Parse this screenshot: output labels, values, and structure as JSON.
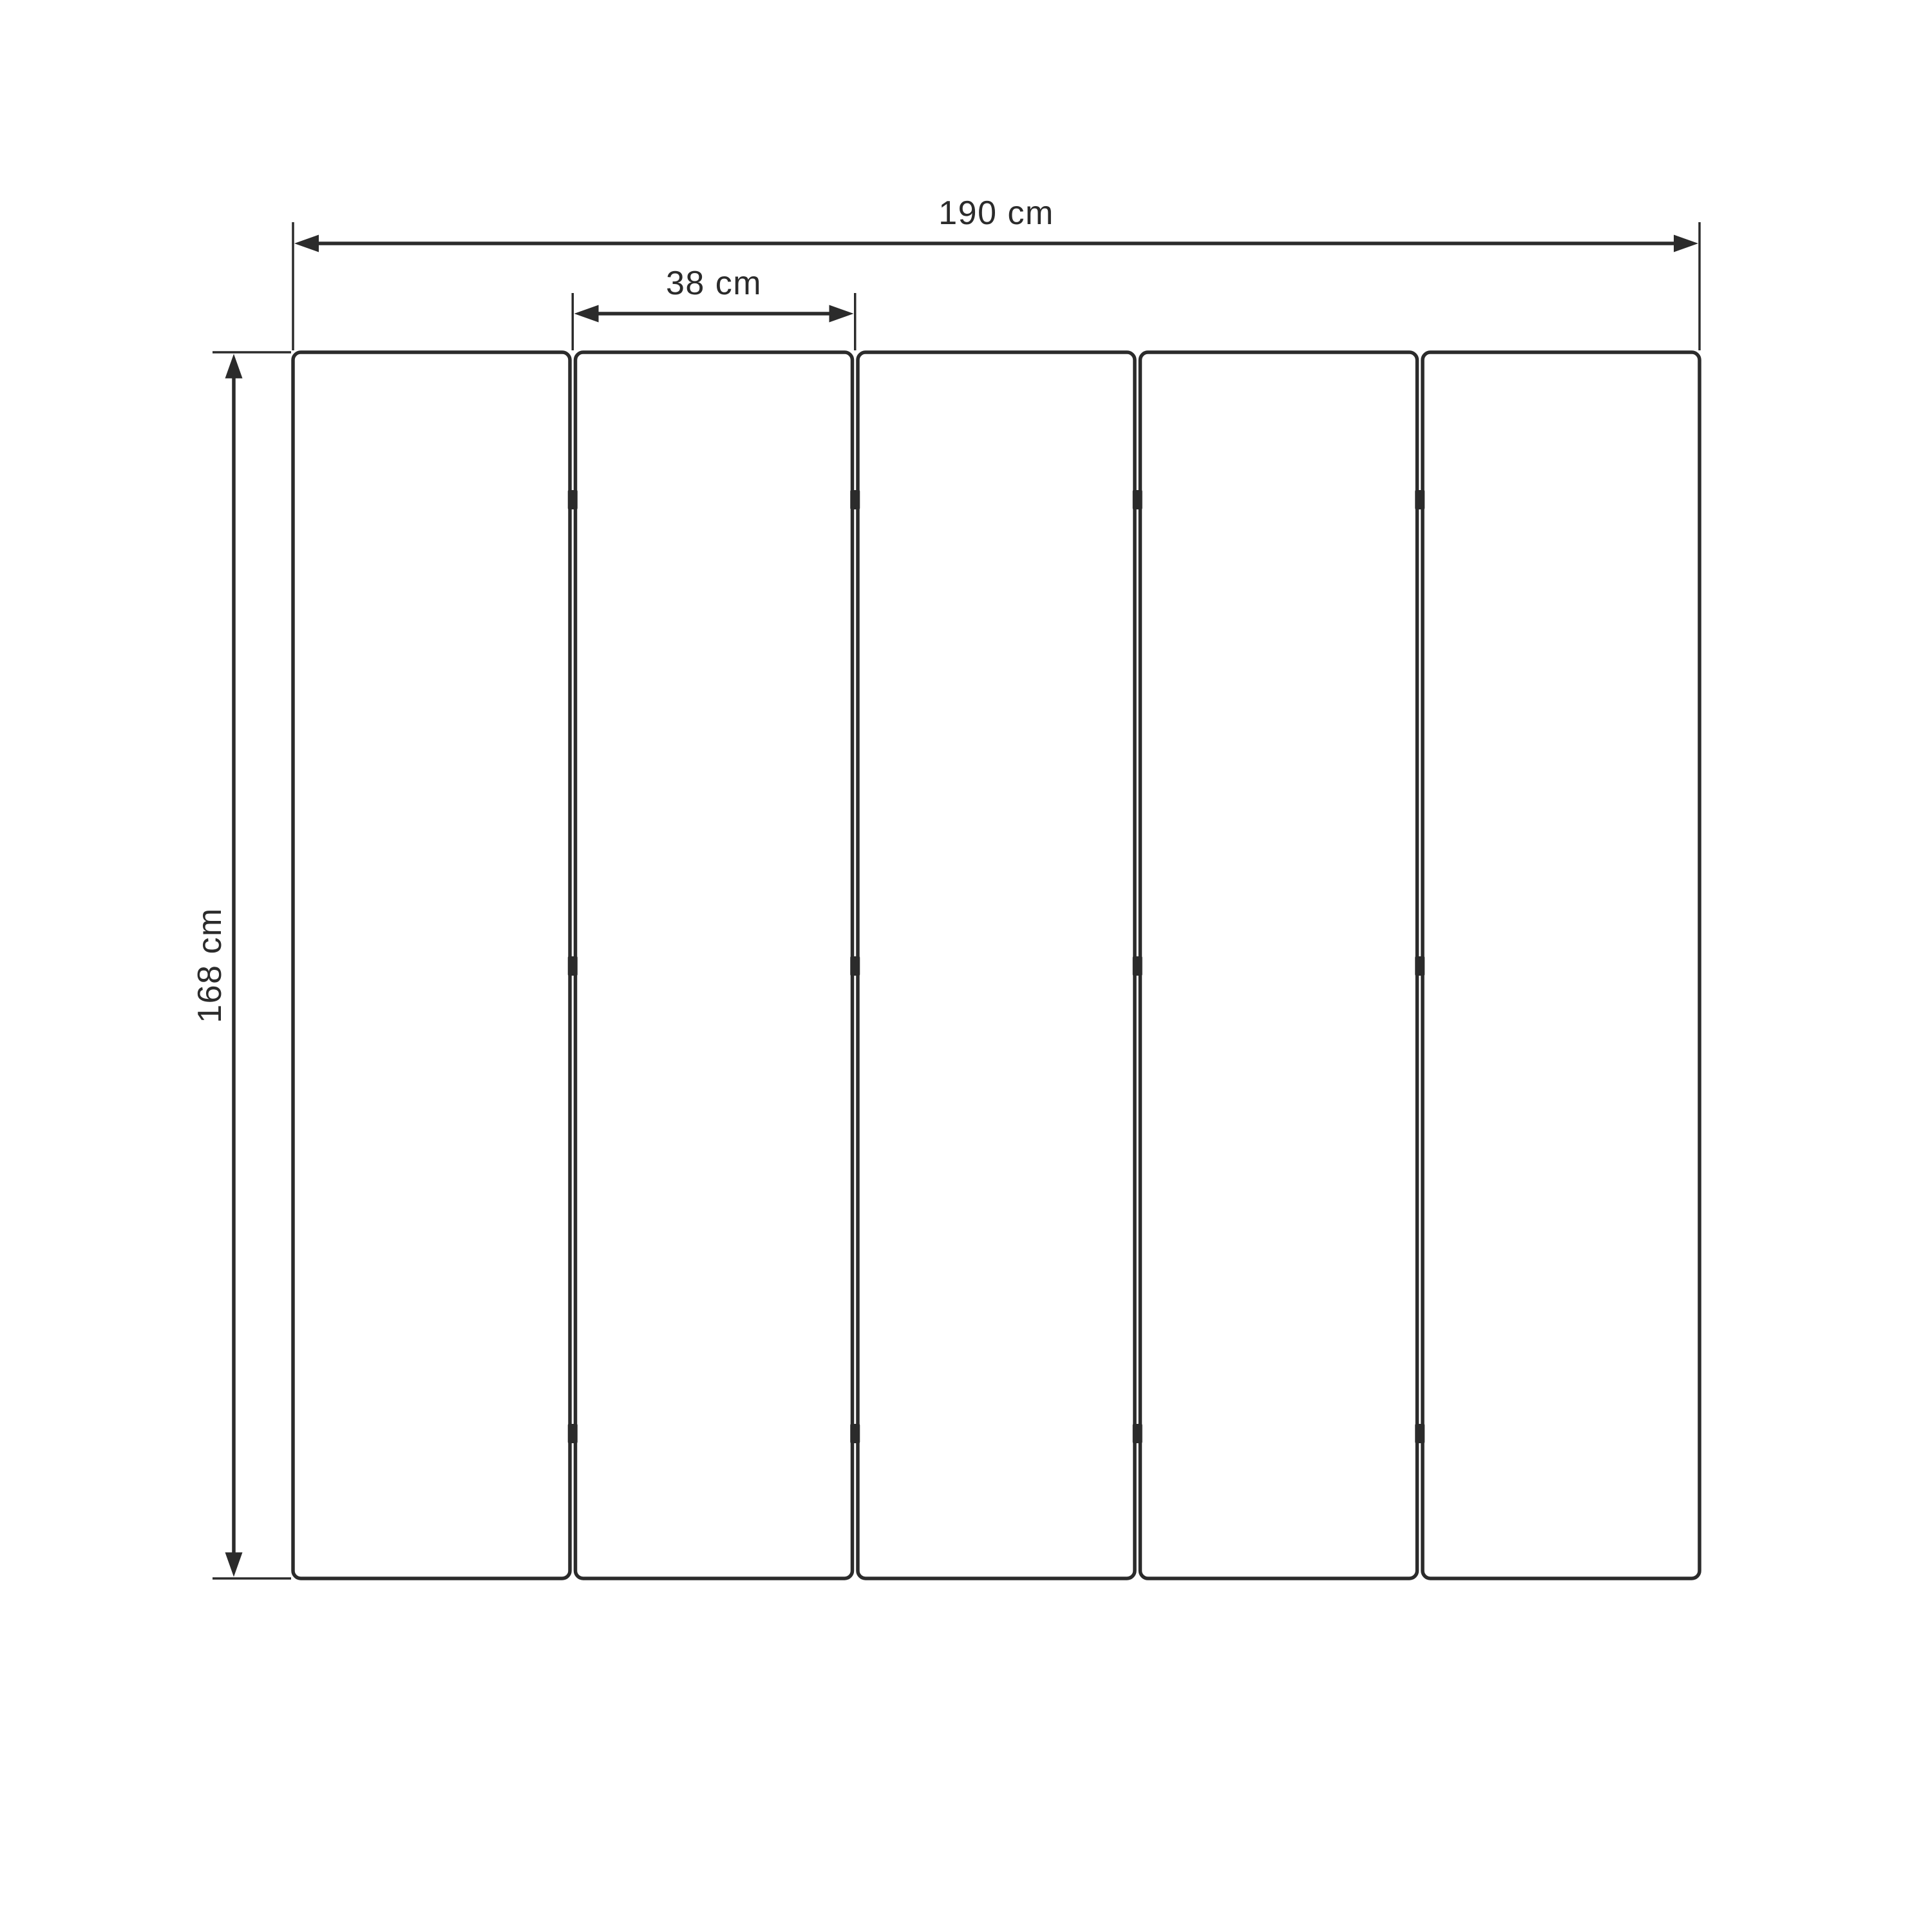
{
  "diagram": {
    "labels": {
      "total_width": "190 cm",
      "panel_width": "38 cm",
      "height": "168 cm"
    },
    "panels": {
      "count": 5,
      "hinge_rows_per_gap": 3
    },
    "colors": {
      "line": "#2b2b2b",
      "panel_fill": "#ffffff",
      "background": "#ffffff"
    }
  }
}
